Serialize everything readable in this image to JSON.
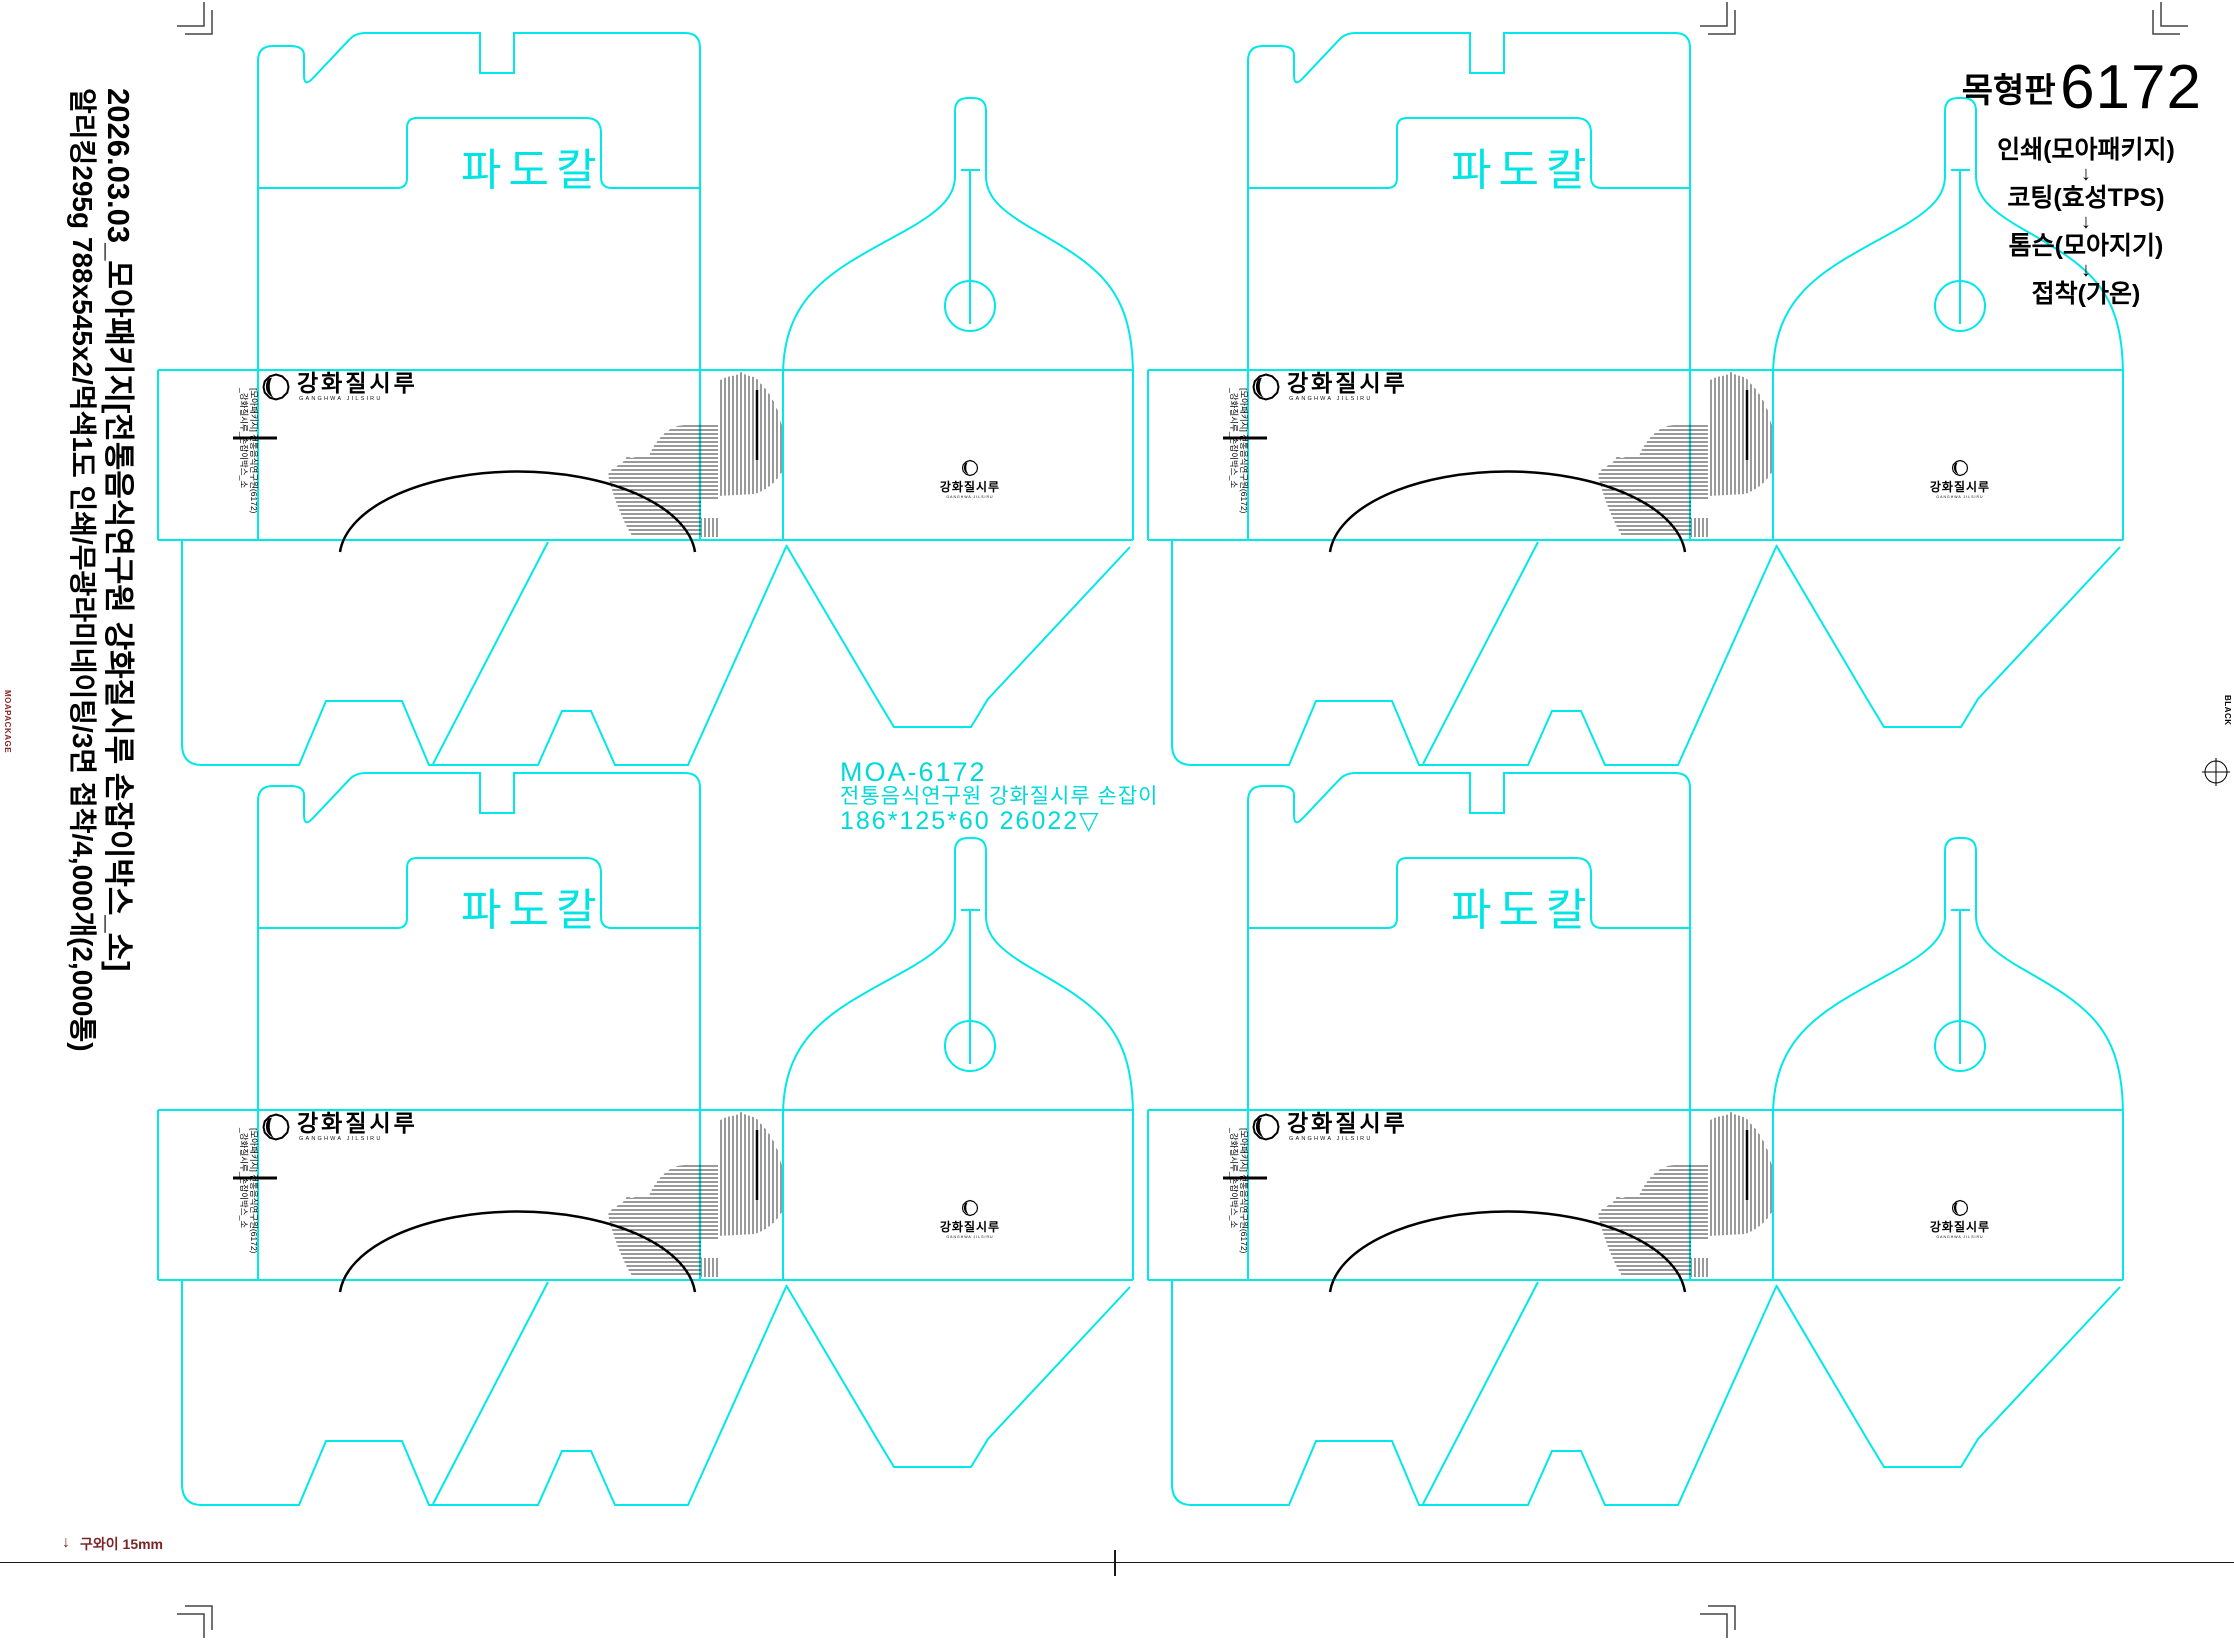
{
  "header": {
    "title_label": "목형판",
    "title_number": "6172",
    "process_steps": [
      "인쇄(모아패키지)",
      "코팅(효성TPS)",
      "톰슨(모아지기)",
      "접착(가온)"
    ],
    "arrow": "↓"
  },
  "side_notes": {
    "line1": "2026.03.03_모아패키지[전통음식연구원 강화질시루 손잡이박스_소]",
    "line2": "알리킹295g 788x545x2/먹색1도 인쇄/무광라미네이팅/3면 접착/4,000개(2,000통)"
  },
  "center_label": {
    "code": "MOA-6172",
    "client": "전통음식연구원 강화질시루 손잡이",
    "dimensions": "186*125*60 26022▽"
  },
  "dieline": {
    "knife_label": "파도칼",
    "brand": "강화질시루",
    "brand_en": "GANGHWA JILSIRU",
    "slug_line1": "[모아패키지] 전통음식연구원(6172)",
    "slug_line2": "_강화질시루_손잡이박스_소"
  },
  "footer": {
    "gripper_label": "구와이 15mm",
    "arrow": "↓"
  },
  "print_marks": {
    "left_slug": "MOAPACKAGE",
    "right_slug": "BLACK"
  },
  "colors": {
    "die_cyan": "#00e8e8",
    "artwork_black": "#000000",
    "gripper_red": "#7a2626"
  }
}
